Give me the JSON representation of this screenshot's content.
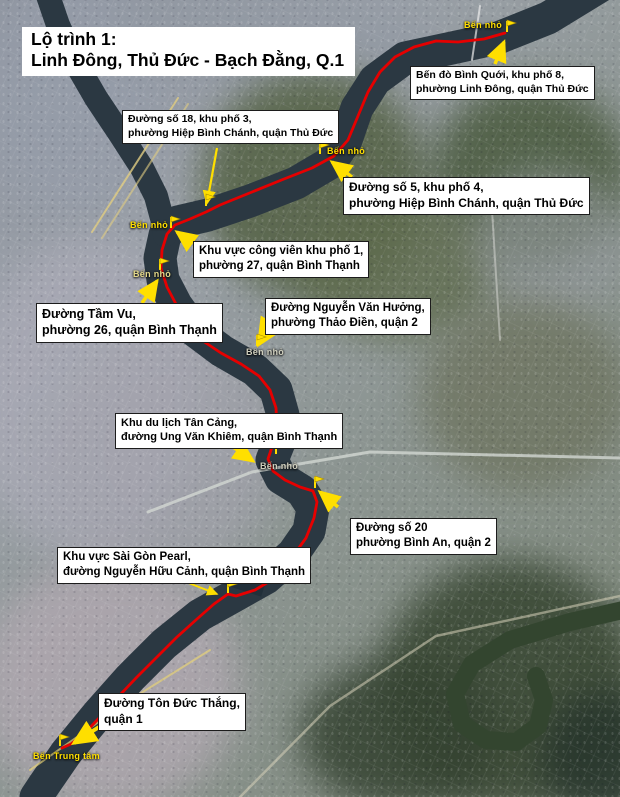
{
  "title": {
    "line1": "Lộ trình 1:",
    "line2": "Linh Đông, Thủ Đức - Bạch Đằng, Q.1"
  },
  "callouts": [
    {
      "id": "ben-do-binh-quoi",
      "line1": "Bến đò Bình Quới, khu phố 8,",
      "line2": "phường Linh Đông, quận Thủ Đức"
    },
    {
      "id": "duong-so-18",
      "line1": "Đường số 18, khu phố 3,",
      "line2": "phường Hiệp Bình Chánh, quận Thủ Đức"
    },
    {
      "id": "duong-so-5",
      "line1": "Đường số 5, khu phố 4,",
      "line2": "phường Hiệp Bình Chánh, quận Thủ Đức"
    },
    {
      "id": "cong-vien-kp1",
      "line1": "Khu vực công viên khu phố 1,",
      "line2": "phường 27, quận Bình Thạnh"
    },
    {
      "id": "tam-vu",
      "line1": "Đường Tầm Vu,",
      "line2": "phường 26, quận Bình Thạnh"
    },
    {
      "id": "nguyen-van-huong",
      "line1": "Đường Nguyễn Văn Hưởng,",
      "line2": "phường Thảo Điền, quận 2"
    },
    {
      "id": "tan-cang",
      "line1": "Khu du lịch Tân Cảng,",
      "line2": "đường Ung Văn Khiêm, quận Bình Thạnh"
    },
    {
      "id": "duong-so-20",
      "line1": "Đường số 20",
      "line2": "phường Bình An, quận 2"
    },
    {
      "id": "sai-gon-pearl",
      "line1": "Khu vực Sài Gòn Pearl,",
      "line2": "đường Nguyễn Hữu Cảnh, quận Bình Thạnh"
    },
    {
      "id": "ton-duc-thang",
      "line1": "Đường Tôn Đức Thắng,",
      "line2": "quận 1"
    }
  ],
  "poi_labels": [
    {
      "text": "Bến nhỏ"
    },
    {
      "text": "Bến nhỏ"
    },
    {
      "text": "Bến nhỏ"
    },
    {
      "text": "Bến nhỏ"
    },
    {
      "text": "Bến nhỏ"
    },
    {
      "text": "Bến nhỏ"
    },
    {
      "text": "Bến Trung tâm"
    }
  ],
  "colors": {
    "route": "#e60000",
    "annotation_yellow": "#ffdf00",
    "label_bg": "#ffffff",
    "label_text": "#000000",
    "river": "#2b3842"
  }
}
